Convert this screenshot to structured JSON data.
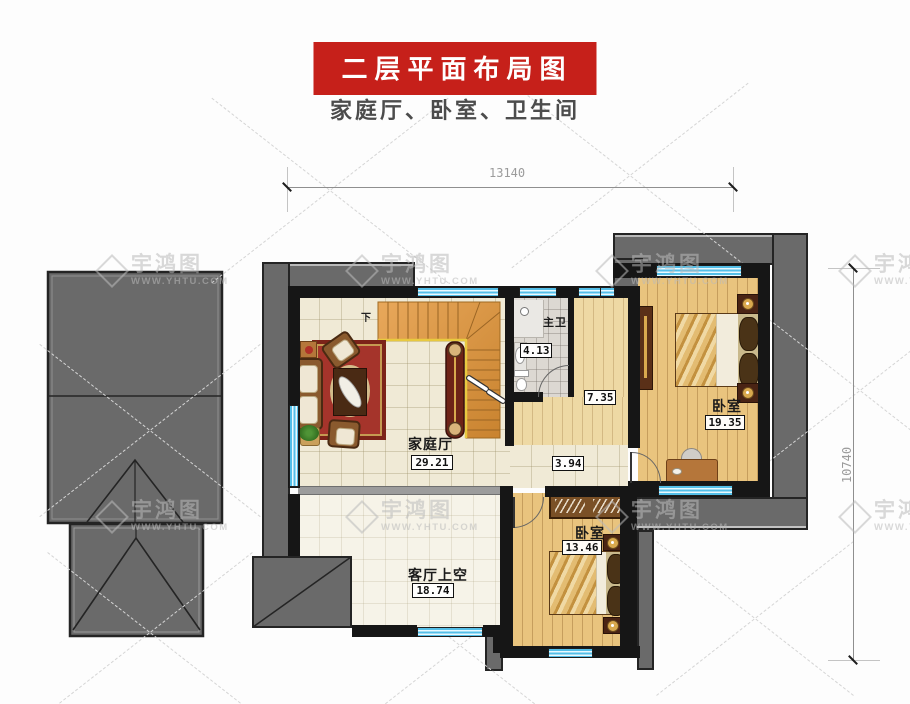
{
  "header": {
    "banner": "二层平面布局图",
    "subtitle": "家庭厅、卧室、卫生间"
  },
  "dimensions": {
    "width_mm": "13140",
    "height_mm": "10740"
  },
  "rooms": {
    "family_hall": {
      "name": "家庭厅",
      "area": "29.21"
    },
    "master_bath": {
      "name": "主卫",
      "area": "4.13"
    },
    "corridor": {
      "area": "7.35"
    },
    "hallway": {
      "area": "3.94"
    },
    "bedroom_east": {
      "name": "卧室",
      "area": "19.35"
    },
    "bedroom_south": {
      "name": "卧室",
      "area": "13.46"
    },
    "living_void": {
      "name": "客厅上空",
      "area": "18.74"
    }
  },
  "stairs": {
    "direction_label": "下"
  },
  "watermark": {
    "name": "宇鸿图",
    "url": "WWW.YHTU.COM"
  },
  "colors": {
    "banner_red": "#c6201a",
    "roof_gray": "#6a6a6a",
    "wall_black": "#161616",
    "window_blue": "#54bfe8",
    "floor_cream": "#f0ead6",
    "floor_wood": "#e9c47e"
  }
}
